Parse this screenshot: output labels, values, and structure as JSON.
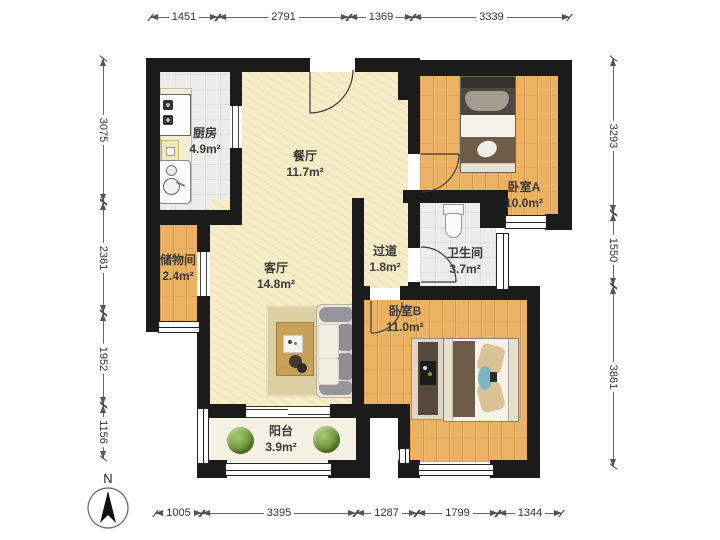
{
  "title": "apartment-floor-plan",
  "rooms": {
    "kitchen": {
      "name": "厨房",
      "area": "4.9m²"
    },
    "dining": {
      "name": "餐厅",
      "area": "11.7m²"
    },
    "bedroom_a": {
      "name": "卧室A",
      "area": "10.0m²"
    },
    "storage": {
      "name": "储物间",
      "area": "2.4m²"
    },
    "living": {
      "name": "客厅",
      "area": "14.8m²"
    },
    "hallway": {
      "name": "过道",
      "area": "1.8m²"
    },
    "bathroom": {
      "name": "卫生间",
      "area": "3.7m²"
    },
    "bedroom_b": {
      "name": "卧室B",
      "area": "11.0m²"
    },
    "balcony": {
      "name": "阳台",
      "area": "3.9m²"
    }
  },
  "dimensions": {
    "top": [
      "1451",
      "2791",
      "1369",
      "3339"
    ],
    "left": [
      "3075",
      "2361",
      "1952",
      "1156"
    ],
    "right": [
      "3293",
      "1550",
      "3861"
    ],
    "bottom": [
      "1005",
      "3395",
      "1287",
      "1799",
      "1344"
    ]
  },
  "compass": {
    "label": "N"
  },
  "colors": {
    "wall": "#1b1b1b",
    "floor_wood": "#eab261",
    "floor_cream": "#f6ecc8",
    "floor_tile": "#ececea",
    "floor_balcony": "#f3f1e4",
    "plant_green": "#6d9636"
  }
}
